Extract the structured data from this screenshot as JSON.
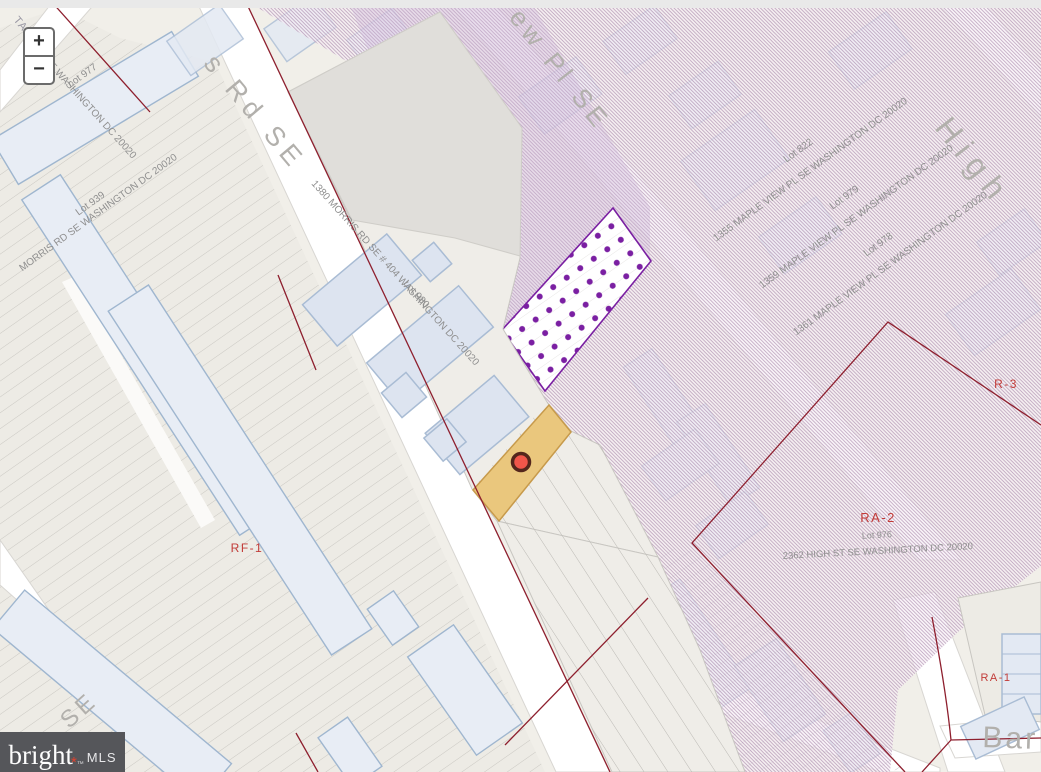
{
  "controls": {
    "zoom_in_label": "+",
    "zoom_out_label": "−"
  },
  "logo": {
    "brand": "bright",
    "star": "*",
    "tm": "™",
    "suffix": "MLS"
  },
  "streets": {
    "morris_rd_partial": "s Rd SE",
    "maple_view_pl_partial": "ew Pl SE",
    "high_st": "High",
    "barry_partial": "Bar",
    "sw_street_partial": "SE",
    "nw_street_partial": "TA"
  },
  "zones": {
    "rf1": "RF-1",
    "r3": "R-3",
    "ra2": "RA-2",
    "ra1": "RA-1"
  },
  "parcels": [
    {
      "id": "lot-977",
      "lot": "Lot 977",
      "address": "SE WASHINGTON DC 20020"
    },
    {
      "id": "lot-939",
      "lot": "Lot 939",
      "address": "MORRIS RD SE WASHINGTON DC 20020"
    },
    {
      "id": "lot-980",
      "lot": "Lot 980",
      "address": "1380 MORRIS RD SE # 404 WASHINGTON DC 20020"
    },
    {
      "id": "lot-822",
      "lot": "Lot 822",
      "address": "1355 MAPLE VIEW PL SE WASHINGTON DC 20020"
    },
    {
      "id": "lot-979",
      "lot": "Lot 979",
      "address": "1359 MAPLE VIEW PL SE WASHINGTON DC 20020"
    },
    {
      "id": "lot-978",
      "lot": "Lot 978",
      "address": "1361 MAPLE VIEW PL SE WASHINGTON DC 20020"
    },
    {
      "id": "lot-976",
      "lot": "Lot 976",
      "address": "2362 HIGH ST SE WASHINGTON DC 20020"
    }
  ],
  "colors": {
    "subject_parcel_fill": "#eac77d",
    "subject_parcel_stroke": "#c79a4b",
    "marker_fill": "#f1564a",
    "marker_ring": "#54261c",
    "zone_boundary_red": "#8e1f2e",
    "zone_label_red": "#c23b38",
    "hatch_line_purple": "#946c98",
    "overlay_dots_purple": "#7a1fa2",
    "building_fill": "#dde4f0",
    "building_stroke": "#a9bcd4",
    "road_white": "#ffffff",
    "land_beige": "#f1efe9",
    "label_gray": "#8f8f8f",
    "street_label_gray": "#b2b0ac",
    "logo_bg": "#55565a",
    "logo_star_red": "#e2422e"
  }
}
